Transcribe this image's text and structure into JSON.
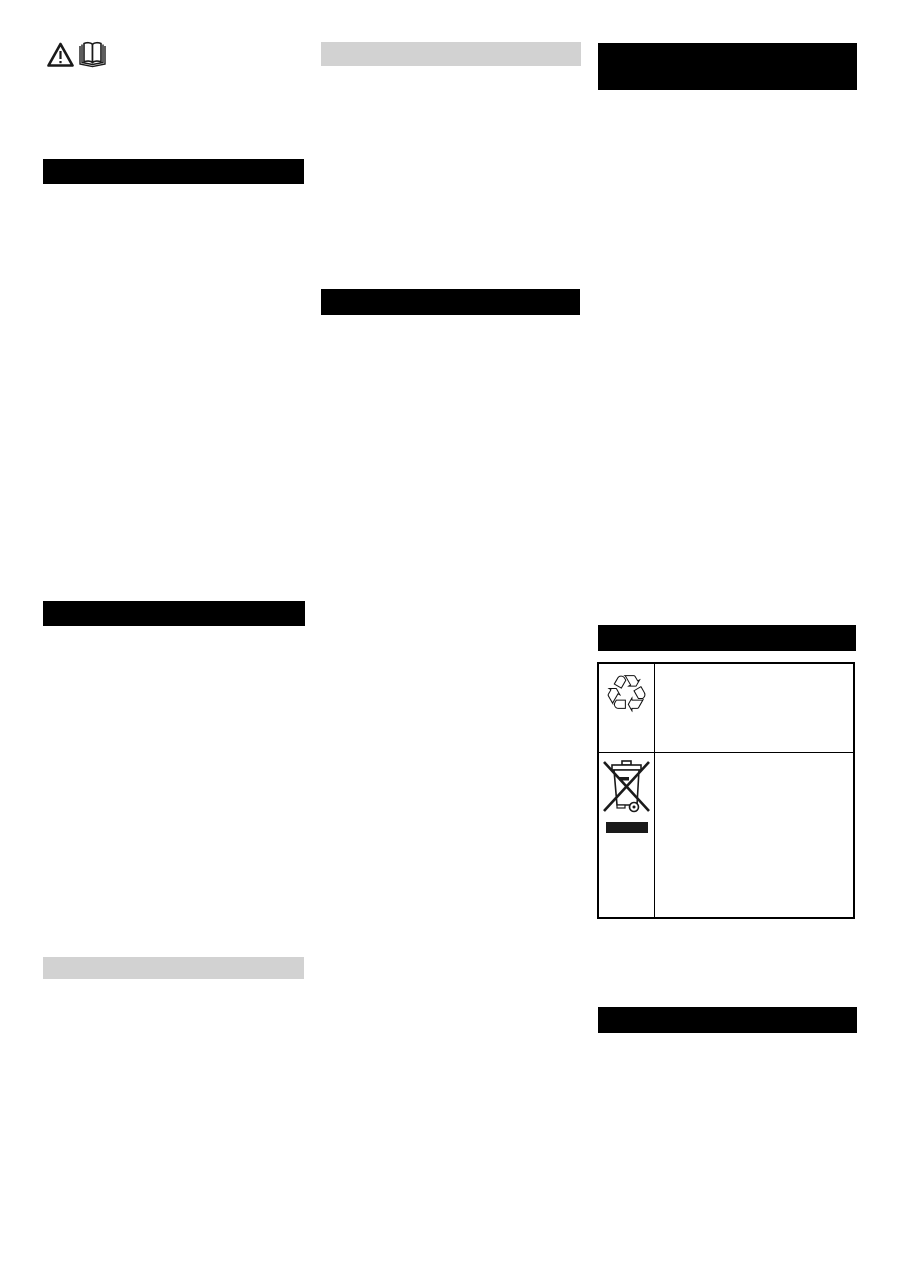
{
  "document": {
    "kind": "scanned instruction manual page, text redacted",
    "background": "#ffffff",
    "columns": 3
  },
  "colors": {
    "redaction_heading_black": "#000000",
    "redaction_heading_gray": "#d2d2d2",
    "table_border": "#000000",
    "icon_stroke": "#1a1a1a",
    "weee_bar_fill": "#1a1a1a"
  },
  "icons": {
    "warning_triangle": {
      "name": "warning-triangle-icon",
      "meaning": "caution / read warnings"
    },
    "open_book": {
      "name": "open-book-icon",
      "meaning": "read the operating manual"
    },
    "recycling": {
      "name": "recycling-symbol-icon",
      "glyph": "♲",
      "meaning": "recyclable packaging materials"
    },
    "weee_bin": {
      "name": "weee-crossed-bin-icon",
      "meaning": "do not dispose with household waste"
    }
  },
  "redactions": {
    "left_column": [
      {
        "id": "left-heading-1",
        "style": "black"
      },
      {
        "id": "left-heading-2",
        "style": "black"
      },
      {
        "id": "left-subheading",
        "style": "gray"
      }
    ],
    "middle_column": [
      {
        "id": "middle-subheading",
        "style": "gray"
      },
      {
        "id": "middle-heading",
        "style": "black"
      }
    ],
    "right_column": [
      {
        "id": "right-heading-1",
        "style": "black",
        "lines": 2
      },
      {
        "id": "right-heading-2",
        "style": "black"
      },
      {
        "id": "right-heading-3",
        "style": "black"
      }
    ]
  },
  "table": {
    "rows": [
      {
        "icon": "recycling-symbol-icon",
        "text": ""
      },
      {
        "icon": "weee-crossed-bin-icon",
        "text": ""
      }
    ]
  }
}
